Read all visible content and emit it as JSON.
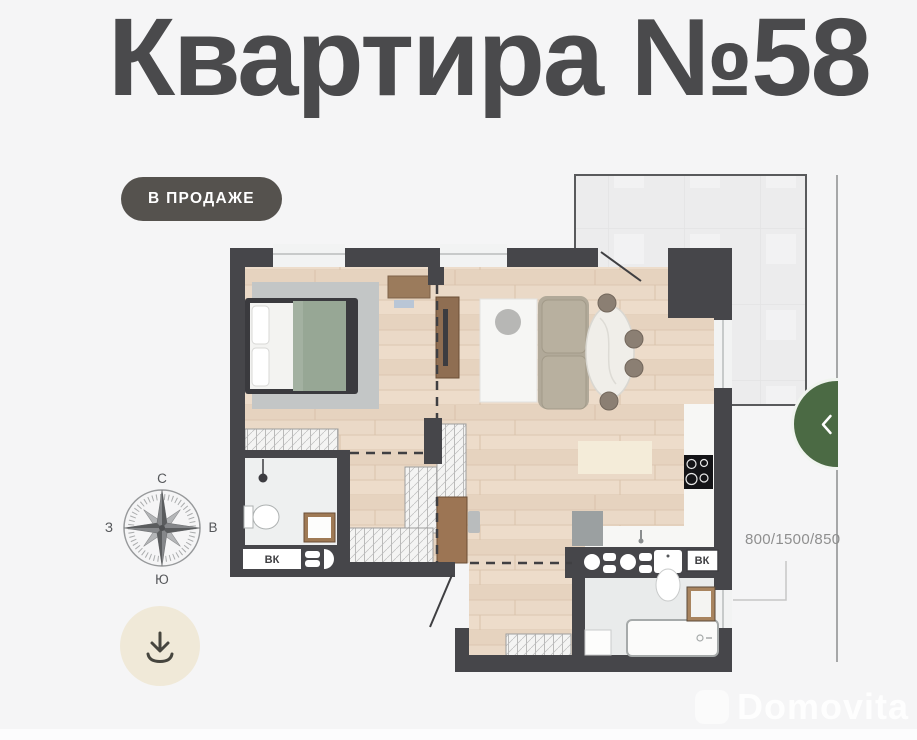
{
  "page": {
    "title": "Квартира №58",
    "status_badge": "В ПРОДАЖЕ",
    "watermark_brand": "Domovita",
    "background_color": "#f5f5f6"
  },
  "plan": {
    "dimension_label": "800/1500/850",
    "vk_label": "ВК",
    "colors": {
      "wall": "#46464a",
      "wood_floor": "#ead9c7",
      "bathroom_floor": "#edeeee",
      "terrace": "#ececed",
      "rug": "#c3c6c6",
      "bed_blanket": "#97a795",
      "sofa": "#b1a999",
      "wood_furniture": "#9b7b5c",
      "plant_green": "#5ea13c",
      "cooktop": "#141417"
    }
  },
  "compass": {
    "north": "С",
    "south": "Ю",
    "west": "З",
    "east": "В"
  },
  "controls": {
    "download_icon": "download-icon",
    "collapse_icon": "chevron-left-icon",
    "accent_green": "#4b6a44",
    "download_button_bg": "#f0e9d8",
    "badge_bg": "#55524e"
  }
}
